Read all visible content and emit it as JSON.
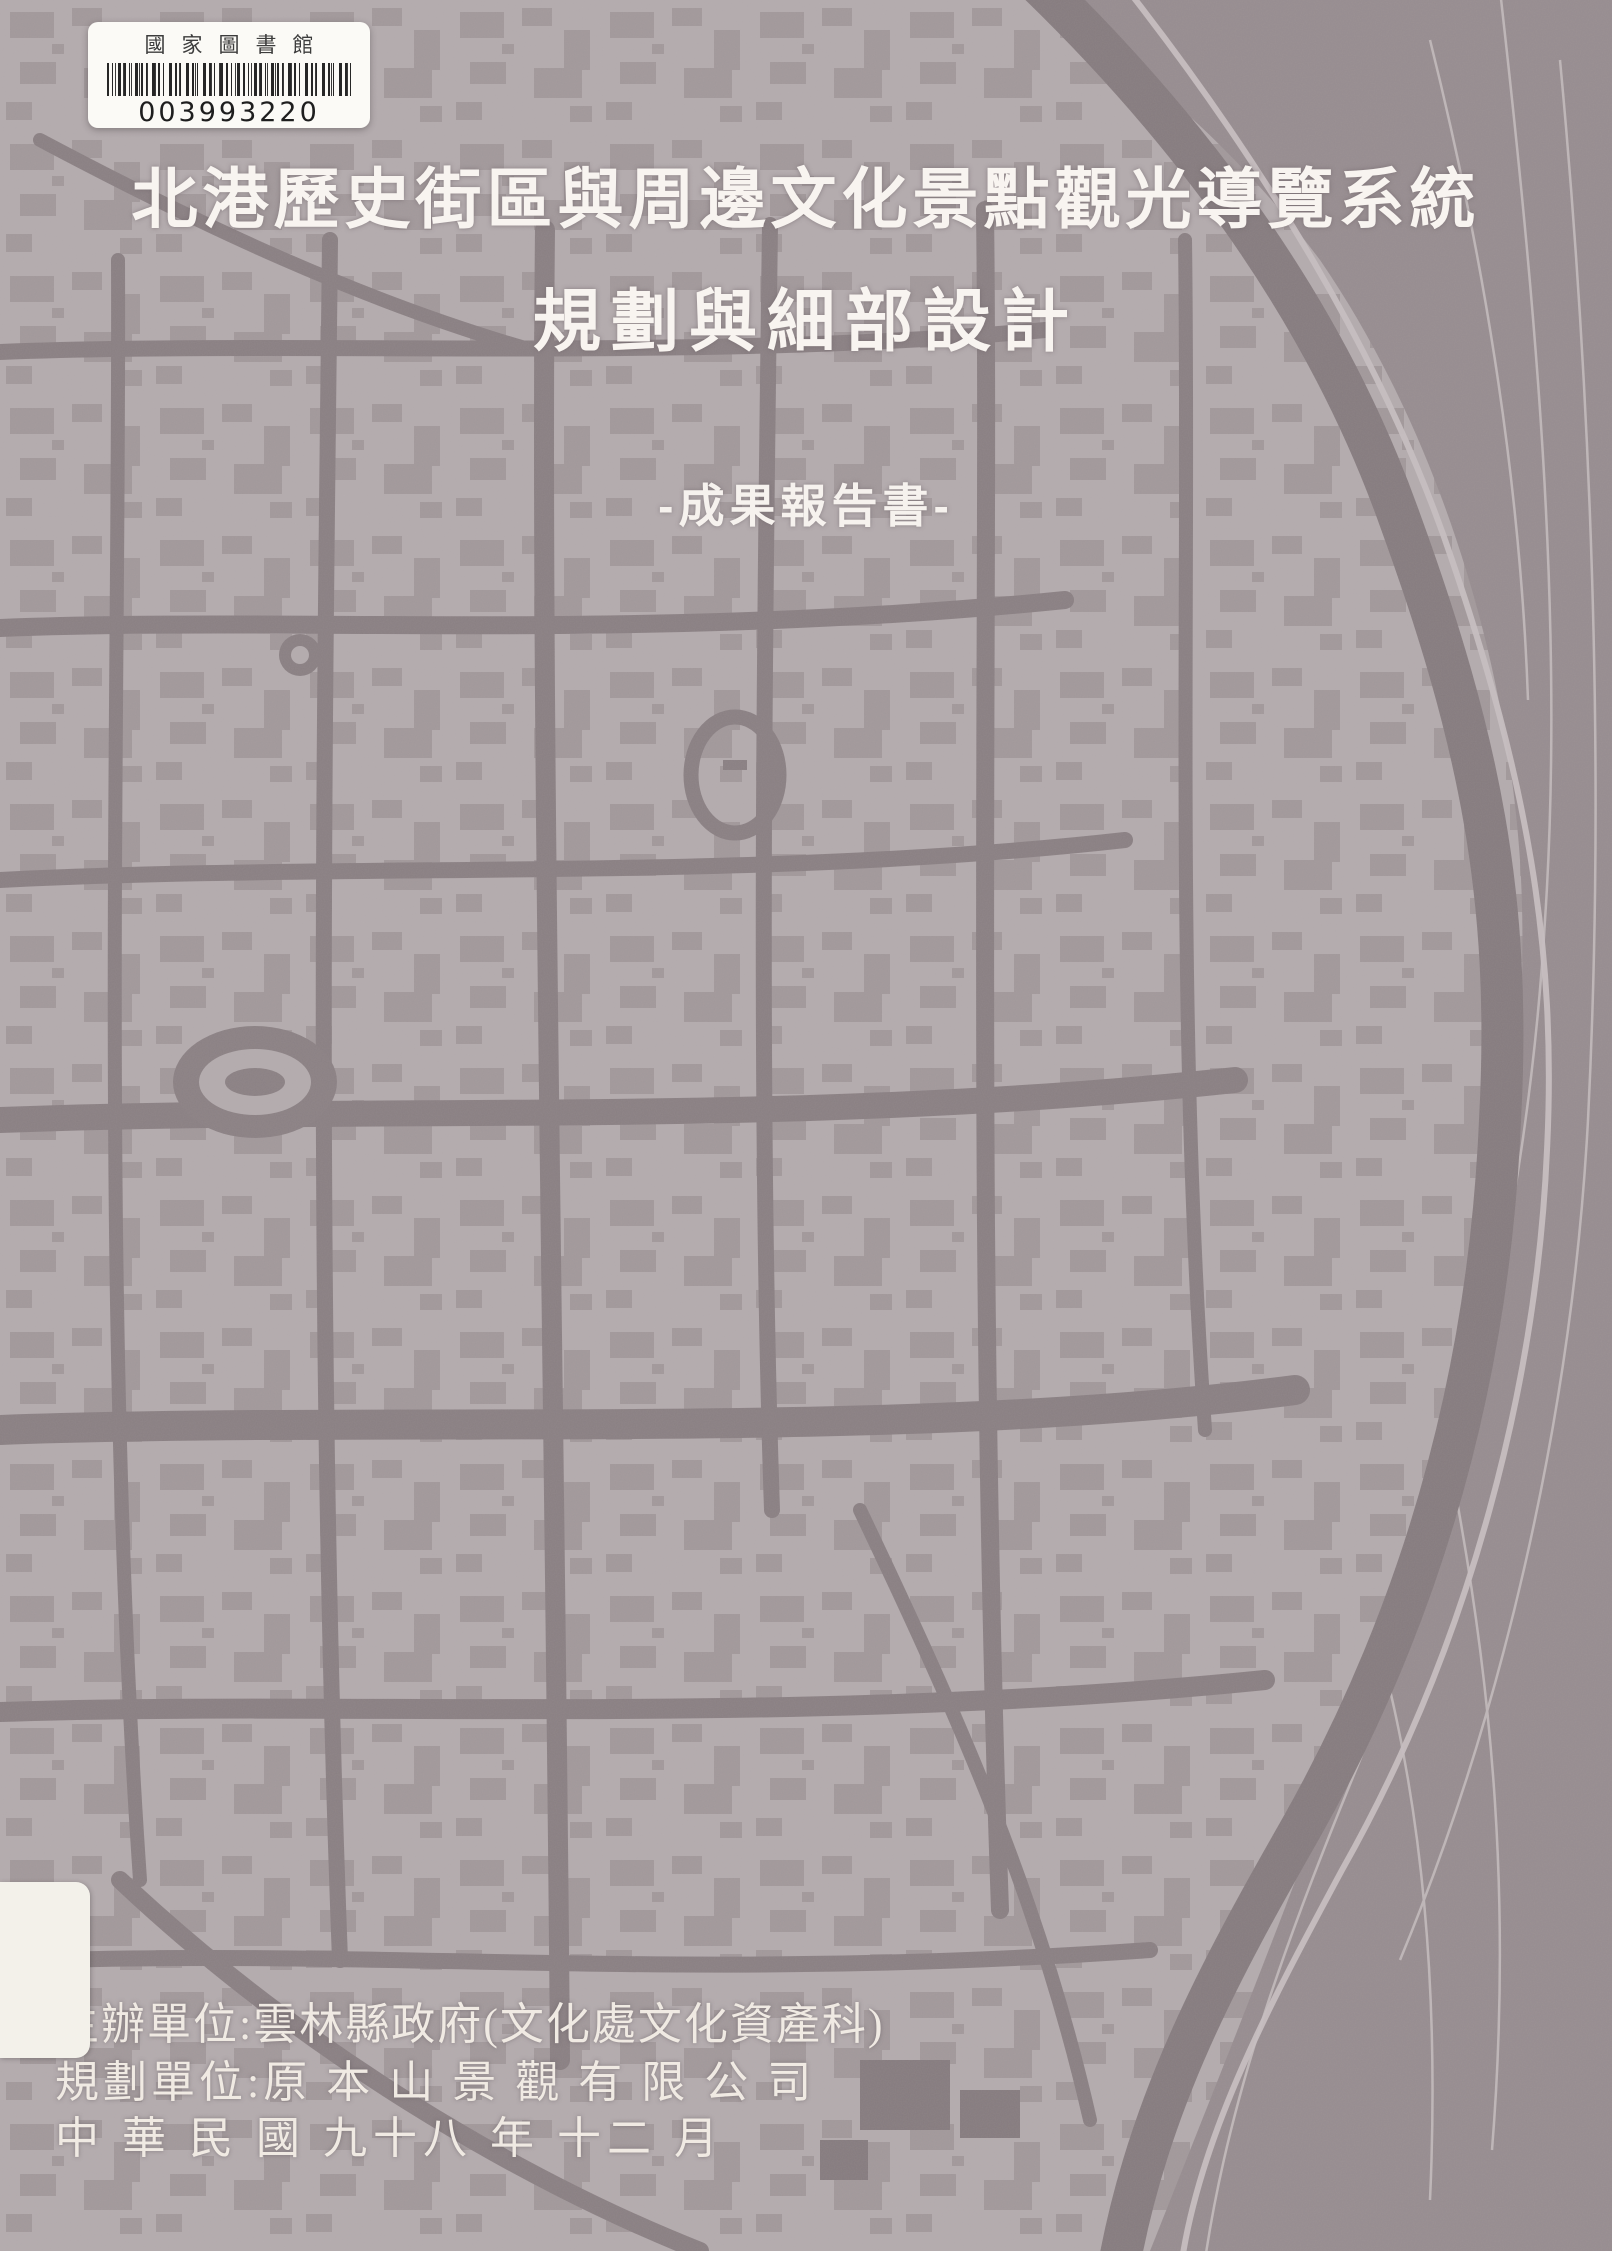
{
  "library_label": {
    "name": "國家圖書館",
    "barcode_number": "003993220"
  },
  "title": {
    "line1": "北港歷史街區與周邊文化景點觀光導覽系統",
    "line2": "規劃與細部設計",
    "subtitle": "-成果報告書-"
  },
  "footer": {
    "organizer": "主辦單位:雲林縣政府(文化處文化資產科)",
    "planner": "規劃單位:原 本 山 景 觀 有 限 公 司",
    "date": "中 華 民 國  九十八 年  十二 月"
  },
  "colors": {
    "map_block_light": "#b2aaac",
    "map_road_dark": "#897f82",
    "map_terrain_dark": "#968c8f",
    "contour_line_light": "#c3bbbc",
    "title_text": "#f8f4f0",
    "label_background": "#fbfaf6",
    "barcode_ink": "#262626"
  }
}
